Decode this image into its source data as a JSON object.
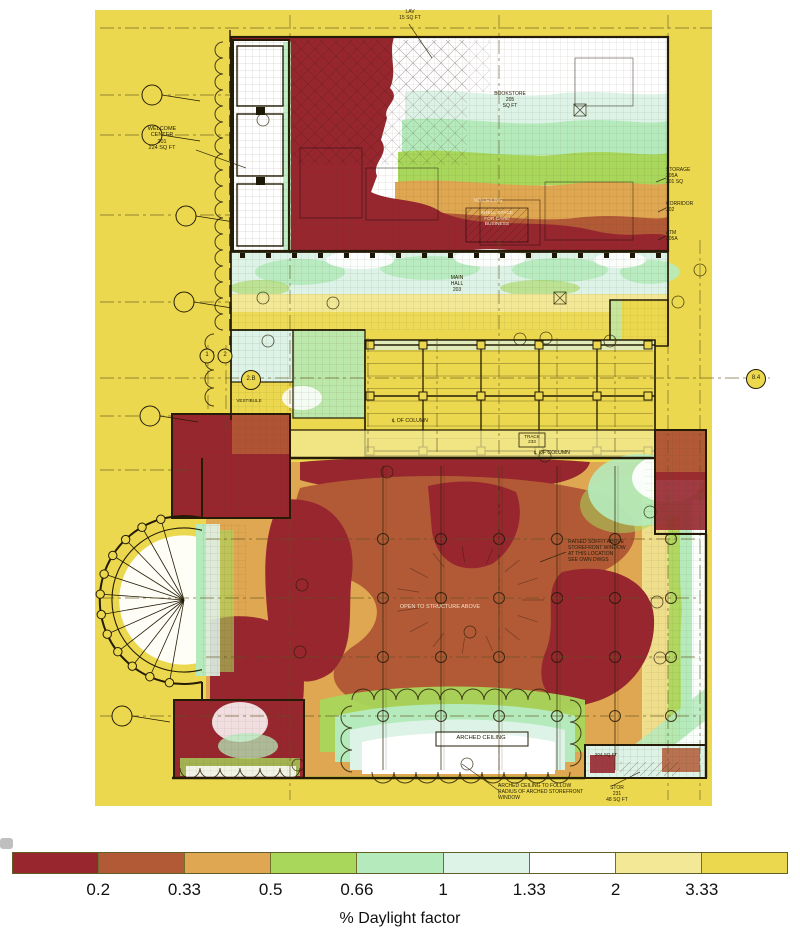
{
  "chart_data": {
    "type": "heatmap",
    "title": "Daylight factor analysis over architectural floor plan",
    "legend": {
      "label": "% Daylight factor",
      "tick_labels": [
        "0.2",
        "0.33",
        "0.5",
        "0.66",
        "1",
        "1.33",
        "2",
        "3.33"
      ],
      "boundaries": [
        0.2,
        0.33,
        0.5,
        0.66,
        1,
        1.33,
        2,
        3.33
      ],
      "colors": [
        "#97262f",
        "#b25a36",
        "#dfa751",
        "#a8d75b",
        "#b5ebbc",
        "#ddf3e7",
        "#ffffff",
        "#f2e896",
        "#ecd84e"
      ],
      "position": "bottom",
      "orientation": "horizontal"
    },
    "regions": [
      {
        "area": "upper block core (bookstore back of house / cafe shell space)",
        "daylight_factor": "< 0.2"
      },
      {
        "area": "bookstore storefront zone (top right)",
        "daylight_factor": "1 - 2"
      },
      {
        "area": "welcome center window bays (top left)",
        "daylight_factor": "1.33 - 2"
      },
      {
        "area": "main hall corridor",
        "daylight_factor": "0.66 - 1.33"
      },
      {
        "area": "skylight trellis court",
        "daylight_factor": "> 3.33"
      },
      {
        "area": "great hall center (open to structure above)",
        "daylight_factor": "0.2 - 0.33"
      },
      {
        "area": "great hall deep lobes (left and right)",
        "daylight_factor": "< 0.2"
      },
      {
        "area": "arched storefront window zone (bottom)",
        "daylight_factor": "0.66 - 2"
      },
      {
        "area": "semicircular stair window (left)",
        "daylight_factor": "2 - 3.33"
      },
      {
        "area": "exterior field",
        "daylight_factor": "> 3.33"
      }
    ]
  },
  "plan": {
    "labels": {
      "lav": "LAV\n15 SQ FT",
      "welcome": "WELCOME\nCENTER\n201\n224 SQ FT",
      "bookstore": "BOOKSTORE\n205\nSQ FT",
      "no_ceiling": "NO CEILING",
      "shell_space": "SHELL SPACE\nFOR CAFE/\nBUSINESS",
      "storage": "STORAGE\n205A\n301 SQ",
      "corridor": "CORRIDOR\n202",
      "atm": "ATM\n205A",
      "main_hall": "MAIN\nHALL\n203",
      "track": "TRACK\n233",
      "col_center_1": "℄ OF COLUMN",
      "col_center_2": "℄ OF COLUMN",
      "vestibule": "VESTIBULE",
      "open_to_structure": "OPEN TO STRUCTURE ABOVE",
      "raised_soffit": "RAISED SOFFIT ABOVE\nSTOREFRONT WINDOW\nAT THIS LOCATION\nSEE OWN DWGS",
      "arched_ceiling": "ARCHED CEILING",
      "arched_note": "ARCHED CEILING TO FOLLOW\nRADIUS OF ARCHED STOREFRONT\nWINDOW",
      "stor_231": "STOR\n231\n48 SQ FT",
      "room_204": "204 SQ FT"
    },
    "bubbles": {
      "b1": "1",
      "b2": "2",
      "b2b": "2.B",
      "b84": "8.4"
    }
  }
}
